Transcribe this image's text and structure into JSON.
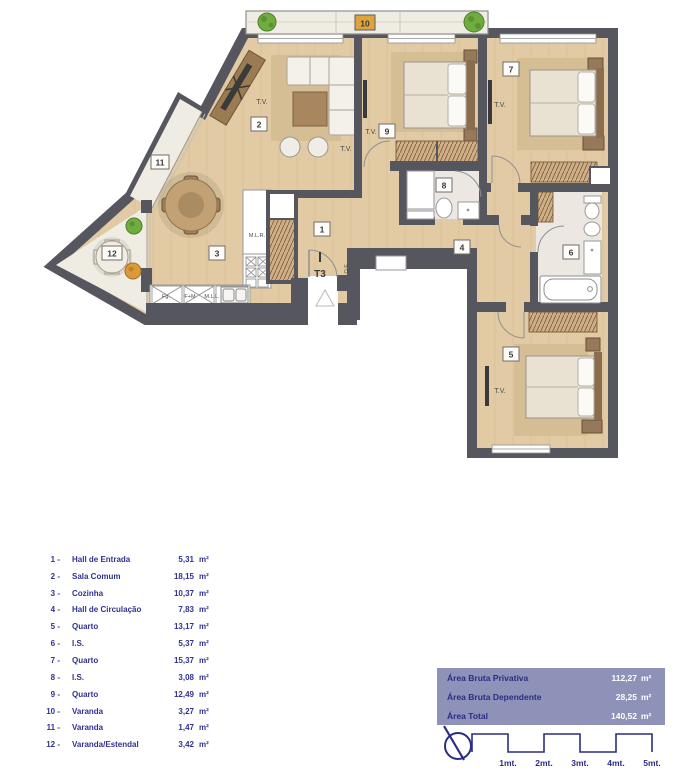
{
  "plan": {
    "type_label": "T3",
    "room_numbers": [
      "1",
      "2",
      "3",
      "4",
      "5",
      "6",
      "7",
      "8",
      "9",
      "10",
      "11",
      "12"
    ],
    "tv_label": "T.V.",
    "electrical_label": "Q.E.",
    "appliances": {
      "mlr": "M.L.R.",
      "fg": "Fg.",
      "fm": "F+M",
      "mll": "M.L.L."
    }
  },
  "legend": {
    "items": [
      {
        "num": "1 -",
        "name": "Hall de Entrada",
        "area": "5,31",
        "unit": "m²"
      },
      {
        "num": "2 -",
        "name": "Sala Comum",
        "area": "18,15",
        "unit": "m²"
      },
      {
        "num": "3 -",
        "name": "Cozinha",
        "area": "10,37",
        "unit": "m²"
      },
      {
        "num": "4 -",
        "name": "Hall de Circulação",
        "area": "7,83",
        "unit": "m²"
      },
      {
        "num": "5 -",
        "name": "Quarto",
        "area": "13,17",
        "unit": "m²"
      },
      {
        "num": "6 -",
        "name": "I.S.",
        "area": "5,37",
        "unit": "m²"
      },
      {
        "num": "7 -",
        "name": "Quarto",
        "area": "15,37",
        "unit": "m²"
      },
      {
        "num": "8 -",
        "name": "I.S.",
        "area": "3,08",
        "unit": "m²"
      },
      {
        "num": "9 -",
        "name": "Quarto",
        "area": "12,49",
        "unit": "m²"
      },
      {
        "num": "10 -",
        "name": "Varanda",
        "area": "3,27",
        "unit": "m²"
      },
      {
        "num": "11 -",
        "name": "Varanda",
        "area": "1,47",
        "unit": "m²"
      },
      {
        "num": "12 -",
        "name": "Varanda/Estendal",
        "area": "3,42",
        "unit": "m²"
      }
    ]
  },
  "areas": {
    "rows": [
      {
        "label": "Área Bruta Privativa",
        "value": "112,27",
        "unit": "m²"
      },
      {
        "label": "Área Bruta Dependente",
        "value": "28,25",
        "unit": "m²"
      },
      {
        "label": "Área Total",
        "value": "140,52",
        "unit": "m²"
      }
    ]
  },
  "scale": {
    "labels": [
      "1mt.",
      "2mt.",
      "3mt.",
      "4mt.",
      "5mt."
    ]
  },
  "colors": {
    "wall": "#56565e",
    "floor": "#e2cba4",
    "rug": "#d5bd94",
    "balcony": "#efece3",
    "bath": "#ece7e0",
    "accent_navy": "#2b2d84",
    "table_bg": "#8e91b8",
    "balcony_label_bg": "#dda43e",
    "plant_green": "#6fae3e",
    "plant_orange": "#d89a3a"
  }
}
